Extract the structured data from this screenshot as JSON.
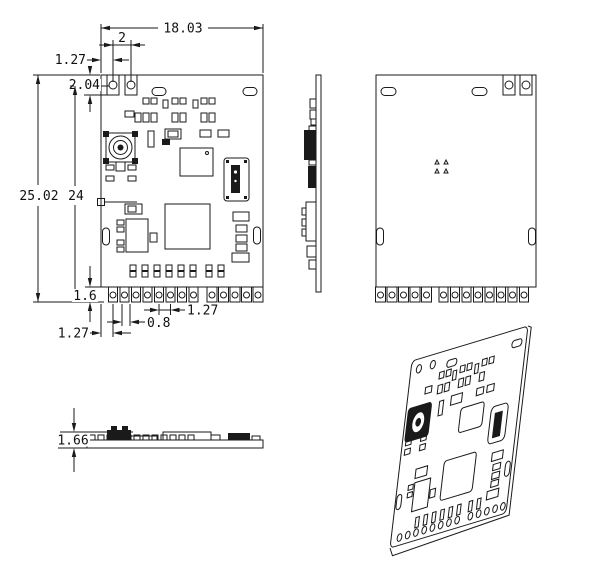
{
  "drawing": {
    "type": "mechanical-dimension-drawing",
    "subject": "castellated PCB radio module",
    "units_implied": "mm",
    "views": [
      "front",
      "side",
      "back",
      "profile",
      "isometric"
    ]
  },
  "dims": {
    "front": {
      "overall_width": "18.03",
      "hole_pitch": "2",
      "hole_offset": "1.27",
      "tab_depth": "2.04",
      "overall_height": "25.02",
      "inner_height": "24",
      "castellation": "1.6",
      "pin_offset": "1.27",
      "pad_width": "0.8",
      "pin_pitch": "1.27"
    },
    "profile": {
      "thickness": "1.66"
    }
  }
}
